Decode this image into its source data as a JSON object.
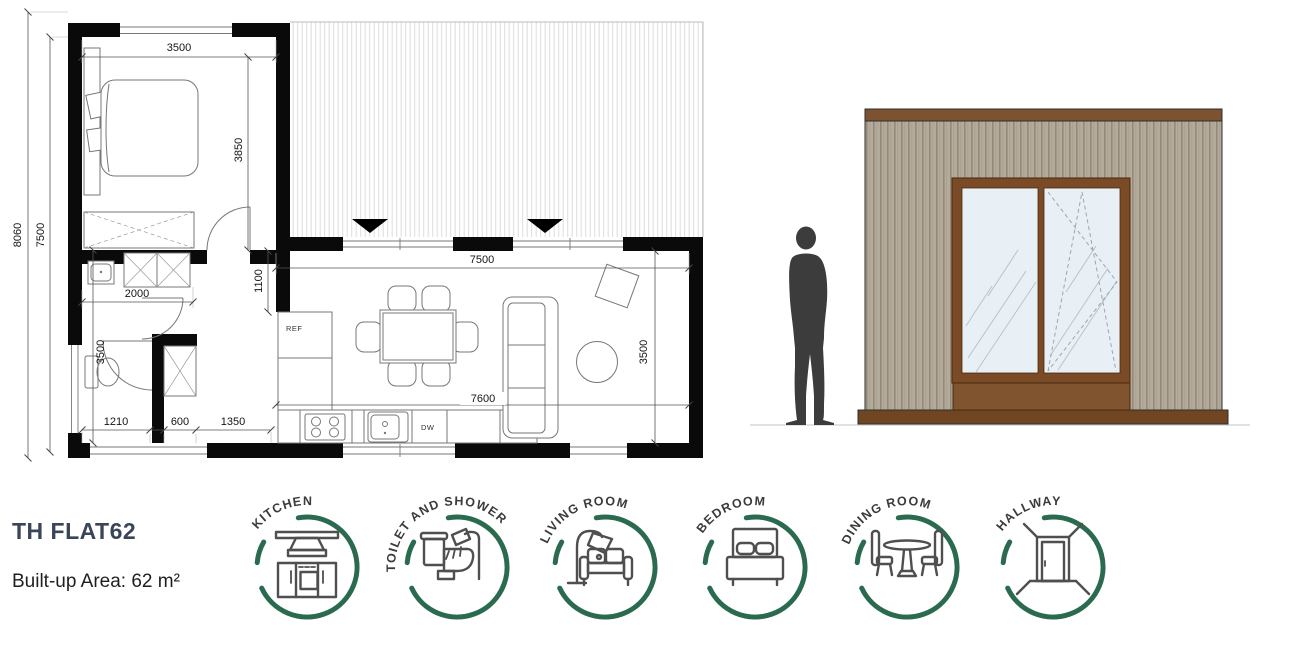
{
  "caption": {
    "title": "TH FLAT62",
    "area": "Built-up Area: 62 m²"
  },
  "floor_plan": {
    "dimensions": {
      "bedroom_width": "3500",
      "bedroom_depth": "3850",
      "overall_depth": "8060",
      "inner_depth": "7500",
      "hall_width": "2000",
      "partition": "1100",
      "living_width": "7500",
      "bath_depth": "3500",
      "bath_width": "1210",
      "closet_width": "600",
      "nook_width": "1350",
      "kitchen_run": "7600",
      "living_depth": "3500"
    },
    "labels": {
      "fridge": "REF",
      "dishwasher": "DW"
    }
  },
  "badges": [
    {
      "label": "KITCHEN"
    },
    {
      "label": "TOILET AND SHOWER"
    },
    {
      "label": "LIVING ROOM"
    },
    {
      "label": "BEDROOM"
    },
    {
      "label": "DINING ROOM"
    },
    {
      "label": "HALLWAY"
    }
  ],
  "colors": {
    "badge_green": "#2a6a4f",
    "title_navy": "#3b4559",
    "wall_black": "#0a0a0a",
    "trim_brown": "#7d5231",
    "frame_brown": "#7b4a26",
    "spandrel_brown": "#815430",
    "base_brown": "#6f4522",
    "siding_tan": "#b5ab9a",
    "glass_blue": "#e9f0f5",
    "silhouette_gray": "#3c3c3c"
  }
}
